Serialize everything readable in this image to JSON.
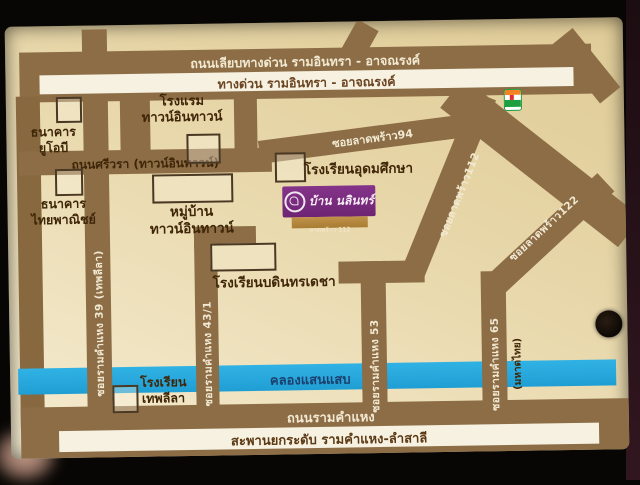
{
  "colors": {
    "card_background": "#e7d6a8",
    "road_brown": "#8c6d46",
    "canal_blue": "#2aa9dd",
    "label_white": "#f2e9d2",
    "label_dark_brown": "#3f2608",
    "canal_text": "#1d3f6d",
    "logo_purple": "#7b2e81",
    "logo_gold": "#b1853c"
  },
  "roads": {
    "liab_expressway": "ถนนเลียบทางด่วน รามอินทรา - อาจณรงค์",
    "expressway": "ทางด่วน รามอินทรา - อาจณรงค์",
    "sriwara": "ถนนศรีวรา (ทาวน์อินทาวน์)",
    "ladprao94": "ซอยลาดพร้าว94",
    "ladprao112": "ซอยลาดพร้าว112",
    "ladprao122": "ซอยลาดพร้าว122",
    "ramkhamhaeng39": "ซอยรามคำแหง 39 (เทพลีลา)",
    "ramkhamhaeng43_1": "ซอยรามคำแหง 43/1",
    "ramkhamhaeng53": "ซอยรามคำแหง 53",
    "ramkhamhaeng65": "ซอยรามคำแหง 65",
    "mahadthai": "(มหาดไทย)",
    "ramkhamhaeng": "ถนนรามคำแหง",
    "bridge": "สะพานยกระดับ รามคำแหง-ลำสาลี"
  },
  "canal": {
    "name": "คลองแสนแสบ"
  },
  "places": {
    "uob_bank": "ธนาคาร\nยูโอบี",
    "scb_bank": "ธนาคาร\nไทยพาณิชย์",
    "hotel": "โรงแรม\nทาวน์อินทาวน์",
    "udomsuksa_school": "โรงเรียนอุดมศึกษา",
    "moo_baan": "หมู่บ้าน\nทาวน์อินทาวน์",
    "bodindecha_school": "โรงเรียนบดินทรเดชา",
    "thepleela_school": "โรงเรียน\nเทพลีลา"
  },
  "landmark": {
    "name": "บ้าน นลินทร์",
    "subtitle": "ลาดพร้าว 112"
  },
  "icons": {
    "seven_eleven": "7-eleven-store-icon",
    "hole_mark": "black-dot-mark"
  }
}
